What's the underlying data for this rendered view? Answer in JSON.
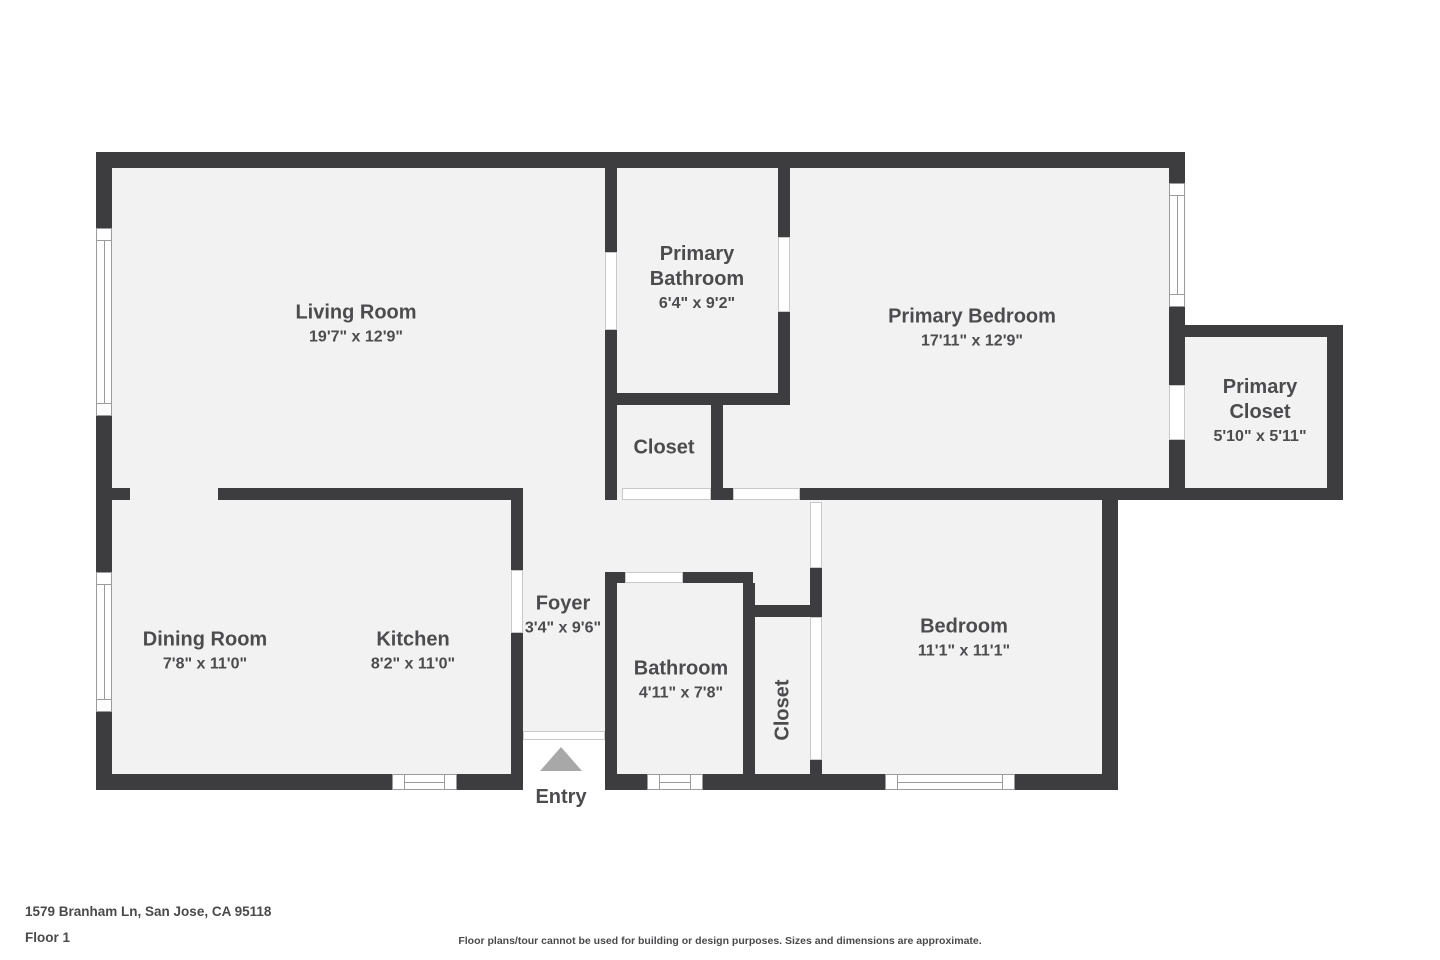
{
  "floorplan": {
    "rooms": {
      "living_room": {
        "name": "Living Room",
        "dims": "19'7\" x 12'9\""
      },
      "primary_bathroom": {
        "name": "Primary Bathroom",
        "dims": "6'4\" x 9'2\""
      },
      "primary_bedroom": {
        "name": "Primary Bedroom",
        "dims": "17'11\" x 12'9\""
      },
      "primary_closet": {
        "name": "Primary Closet",
        "dims": "5'10\" x 5'11\""
      },
      "hall_closet": {
        "name": "Closet"
      },
      "dining_room": {
        "name": "Dining Room",
        "dims": "7'8\" x 11'0\""
      },
      "kitchen": {
        "name": "Kitchen",
        "dims": "8'2\" x 11'0\""
      },
      "foyer": {
        "name": "Foyer",
        "dims": "3'4\" x 9'6\""
      },
      "bathroom": {
        "name": "Bathroom",
        "dims": "4'11\" x 7'8\""
      },
      "bedroom_closet": {
        "name": "Closet"
      },
      "bedroom": {
        "name": "Bedroom",
        "dims": "11'1\" x 11'1\""
      }
    },
    "entry_label": "Entry"
  },
  "footer": {
    "address": "1579 Branham Ln, San Jose, CA 95118",
    "floor": "Floor 1",
    "disclaimer": "Floor plans/tour cannot be used for building or design purposes. Sizes and dimensions are approximate."
  },
  "colors": {
    "wall": "#3d3d3f",
    "floor": "#f2f2f2",
    "window_frame": "#9b9b9b",
    "door_jamb": "#c9c9c9",
    "entry_arrow": "#a8a8a8",
    "label_text": "#4c4c4f"
  }
}
